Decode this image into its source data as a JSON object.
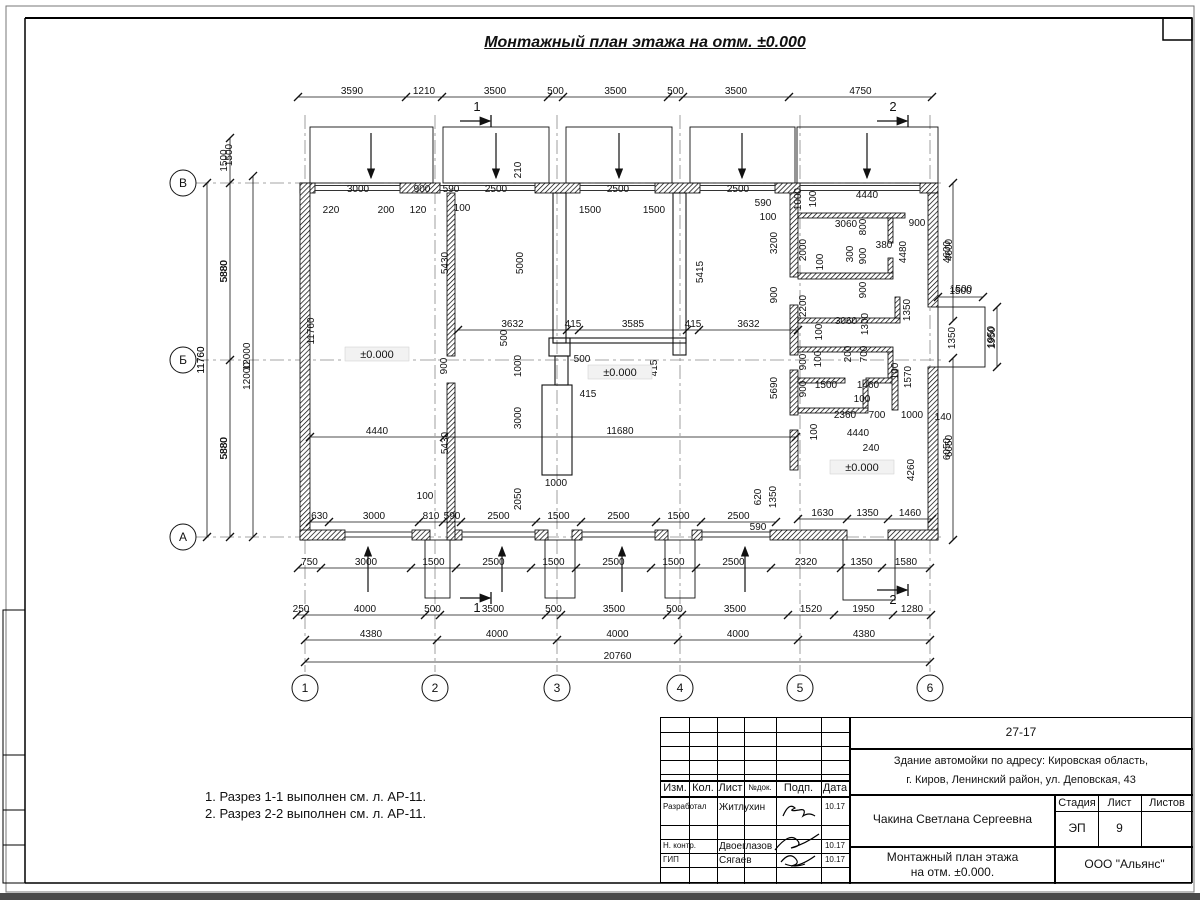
{
  "title": "Монтажный план этажа на отм. ±0.000",
  "notes": [
    "1. Разрез 1-1 выполнен см. л. АР-11.",
    "2. Разрез 2-2 выполнен см. л. АР-11."
  ],
  "colors": {
    "line": "#111111",
    "grid": "#888888",
    "level_bg": "#f2f2f2"
  },
  "plan": {
    "grid": {
      "cols": [
        {
          "label": "1",
          "x": 305
        },
        {
          "label": "2",
          "x": 435
        },
        {
          "label": "3",
          "x": 557
        },
        {
          "label": "4",
          "x": 680
        },
        {
          "label": "5",
          "x": 800
        },
        {
          "label": "6",
          "x": 930
        }
      ],
      "rows": [
        {
          "label": "В",
          "y": 183
        },
        {
          "label": "Б",
          "y": 360
        },
        {
          "label": "А",
          "y": 537
        }
      ]
    },
    "levels": [
      {
        "text": "±0.000",
        "x": 377,
        "y": 357
      },
      {
        "text": "±0.000",
        "x": 620,
        "y": 375
      },
      {
        "text": "±0.000",
        "x": 862,
        "y": 470
      }
    ],
    "sections": [
      {
        "label": "1",
        "tx": 477,
        "ty": 111,
        "lx": 460,
        "ly": 121
      },
      {
        "label": "2",
        "tx": 893,
        "ty": 111,
        "lx": 877,
        "ly": 121
      },
      {
        "label": "1",
        "tx": 477,
        "ty": 612,
        "lx": 460,
        "ly": 598
      },
      {
        "label": "2",
        "tx": 893,
        "ty": 604,
        "lx": 877,
        "ly": 590
      }
    ],
    "chains_h": [
      {
        "y": 97,
        "xs": [
          298,
          406,
          442,
          548,
          563,
          668,
          683,
          789,
          932
        ],
        "labels": [
          "3590",
          "1210",
          "3500",
          "500",
          "3500",
          "500",
          "3500",
          "4750"
        ]
      },
      {
        "y": 522,
        "xs": [
          310,
          329,
          419,
          443,
          461,
          536,
          581,
          656,
          701,
          776
        ],
        "labels": [
          "630",
          "3000",
          "810",
          "590",
          "2500",
          "1500",
          "2500",
          "1500",
          "2500"
        ]
      },
      {
        "y": 519,
        "xs": [
          798,
          847,
          888,
          932
        ],
        "labels": [
          "1630",
          "1350",
          "1460"
        ]
      },
      {
        "y": 568,
        "xs": [
          298,
          321,
          411,
          456,
          531,
          576,
          651,
          696,
          771,
          841,
          882,
          930
        ],
        "labels": [
          "750",
          "3000",
          "1500",
          "2500",
          "1500",
          "2500",
          "1500",
          "2500",
          "2320",
          "1350",
          "1580"
        ]
      },
      {
        "y": 615,
        "xs": [
          297,
          305,
          425,
          440,
          546,
          561,
          667,
          682,
          788,
          834,
          893,
          931
        ],
        "labels": [
          "250",
          "4000",
          "500",
          "3500",
          "500",
          "3500",
          "500",
          "3500",
          "1520",
          "1950",
          "1280"
        ]
      },
      {
        "y": 640,
        "xs": [
          305,
          437,
          557,
          678,
          798,
          930
        ],
        "labels": [
          "4380",
          "4000",
          "4000",
          "4000",
          "4380"
        ]
      },
      {
        "y": 662,
        "xs": [
          305,
          930
        ],
        "labels": [
          "20760"
        ]
      },
      {
        "y": 330,
        "xs": [
          458,
          567,
          579,
          687,
          699,
          798
        ],
        "labels": [
          "3632",
          "415",
          "3585",
          "415",
          "3632"
        ]
      },
      {
        "y": 437,
        "xs": [
          310,
          444,
          796
        ],
        "labels": [
          "4440",
          "11680"
        ]
      },
      {
        "y": 297,
        "xs": [
          938,
          983
        ],
        "labels": [
          "1500"
        ]
      }
    ],
    "chains_v": [
      {
        "x": 207,
        "ys": [
          183,
          537
        ],
        "labels": [
          "11760"
        ]
      },
      {
        "x": 230,
        "ys": [
          138,
          183,
          360,
          537
        ],
        "labels": [
          "1500",
          "5880",
          "5880"
        ]
      },
      {
        "x": 253,
        "ys": [
          176,
          537
        ],
        "labels": [
          "12000"
        ]
      },
      {
        "x": 953,
        "ys": [
          183,
          321
        ],
        "labels": [
          "4600"
        ]
      },
      {
        "x": 953,
        "ys": [
          358,
          540
        ],
        "labels": [
          "6050"
        ]
      },
      {
        "x": 997,
        "ys": [
          307,
          367
        ],
        "labels": [
          "1950"
        ]
      }
    ],
    "labels": [
      {
        "t": "3000",
        "x": 358,
        "y": 192
      },
      {
        "t": "900",
        "x": 422,
        "y": 192
      },
      {
        "t": "590",
        "x": 451,
        "y": 192
      },
      {
        "t": "2500",
        "x": 496,
        "y": 192
      },
      {
        "t": "2500",
        "x": 618,
        "y": 192
      },
      {
        "t": "2500",
        "x": 738,
        "y": 192
      },
      {
        "t": "590",
        "x": 763,
        "y": 206
      },
      {
        "t": "100",
        "x": 768,
        "y": 220
      },
      {
        "t": "4440",
        "x": 867,
        "y": 198
      },
      {
        "t": "220",
        "x": 331,
        "y": 213
      },
      {
        "t": "200",
        "x": 386,
        "y": 213
      },
      {
        "t": "120",
        "x": 418,
        "y": 213
      },
      {
        "t": "100",
        "x": 462,
        "y": 211
      },
      {
        "t": "1500",
        "x": 590,
        "y": 213
      },
      {
        "t": "1500",
        "x": 654,
        "y": 213
      },
      {
        "t": "210",
        "x": 521,
        "y": 170,
        "r": 1
      },
      {
        "t": "1500",
        "x": 232,
        "y": 155,
        "r": 1
      },
      {
        "t": "5880",
        "x": 227,
        "y": 271,
        "r": 1
      },
      {
        "t": "5880",
        "x": 227,
        "y": 448,
        "r": 1
      },
      {
        "t": "11760",
        "x": 204,
        "y": 360,
        "r": 1
      },
      {
        "t": "12000",
        "x": 250,
        "y": 376,
        "r": 1
      },
      {
        "t": "11760",
        "x": 314,
        "y": 331,
        "r": 1
      },
      {
        "t": "5430",
        "x": 448,
        "y": 263,
        "r": 1
      },
      {
        "t": "900",
        "x": 447,
        "y": 366,
        "r": 1
      },
      {
        "t": "5430",
        "x": 448,
        "y": 443,
        "r": 1
      },
      {
        "t": "5000",
        "x": 523,
        "y": 263,
        "r": 1
      },
      {
        "t": "5415",
        "x": 703,
        "y": 272,
        "r": 1
      },
      {
        "t": "500",
        "x": 507,
        "y": 338,
        "r": 1
      },
      {
        "t": "1000",
        "x": 521,
        "y": 366,
        "r": 1
      },
      {
        "t": "500",
        "x": 582,
        "y": 362
      },
      {
        "t": "415",
        "x": 657,
        "y": 368,
        "r": 1
      },
      {
        "t": "415",
        "x": 588,
        "y": 397
      },
      {
        "t": "3000",
        "x": 521,
        "y": 418,
        "r": 1
      },
      {
        "t": "2050",
        "x": 521,
        "y": 499,
        "r": 1
      },
      {
        "t": "1000",
        "x": 556,
        "y": 486
      },
      {
        "t": "100",
        "x": 425,
        "y": 499
      },
      {
        "t": "620",
        "x": 761,
        "y": 497,
        "r": 1
      },
      {
        "t": "1350",
        "x": 776,
        "y": 497,
        "r": 1
      },
      {
        "t": "590",
        "x": 758,
        "y": 530
      },
      {
        "t": "5690",
        "x": 777,
        "y": 388,
        "r": 1
      },
      {
        "t": "900",
        "x": 777,
        "y": 295,
        "r": 1
      },
      {
        "t": "3200",
        "x": 777,
        "y": 243,
        "r": 1
      },
      {
        "t": "1000",
        "x": 801,
        "y": 199,
        "r": 1
      },
      {
        "t": "100",
        "x": 816,
        "y": 199,
        "r": 1
      },
      {
        "t": "3060",
        "x": 846,
        "y": 227
      },
      {
        "t": "800",
        "x": 866,
        "y": 227,
        "r": 1
      },
      {
        "t": "900",
        "x": 917,
        "y": 226
      },
      {
        "t": "380",
        "x": 884,
        "y": 248
      },
      {
        "t": "2000",
        "x": 806,
        "y": 250,
        "r": 1
      },
      {
        "t": "100",
        "x": 823,
        "y": 262,
        "r": 1
      },
      {
        "t": "300",
        "x": 853,
        "y": 254,
        "r": 1
      },
      {
        "t": "900",
        "x": 866,
        "y": 256,
        "r": 1
      },
      {
        "t": "4480",
        "x": 906,
        "y": 252,
        "r": 1
      },
      {
        "t": "4600",
        "x": 952,
        "y": 250,
        "r": 1
      },
      {
        "t": "2200",
        "x": 806,
        "y": 306,
        "r": 1
      },
      {
        "t": "900",
        "x": 866,
        "y": 290,
        "r": 1
      },
      {
        "t": "3060",
        "x": 846,
        "y": 324
      },
      {
        "t": "1300",
        "x": 868,
        "y": 324,
        "r": 1
      },
      {
        "t": "100",
        "x": 822,
        "y": 332,
        "r": 1
      },
      {
        "t": "1350",
        "x": 910,
        "y": 310,
        "r": 1
      },
      {
        "t": "1500",
        "x": 961,
        "y": 292
      },
      {
        "t": "1350",
        "x": 955,
        "y": 338,
        "r": 1
      },
      {
        "t": "1950",
        "x": 995,
        "y": 338,
        "r": 1
      },
      {
        "t": "900",
        "x": 806,
        "y": 362,
        "r": 1
      },
      {
        "t": "100",
        "x": 821,
        "y": 359,
        "r": 1
      },
      {
        "t": "200",
        "x": 851,
        "y": 354,
        "r": 1
      },
      {
        "t": "700",
        "x": 867,
        "y": 354,
        "r": 1
      },
      {
        "t": "900",
        "x": 806,
        "y": 389,
        "r": 1
      },
      {
        "t": "100",
        "x": 898,
        "y": 371,
        "r": 1
      },
      {
        "t": "1570",
        "x": 911,
        "y": 377,
        "r": 1
      },
      {
        "t": "1500",
        "x": 826,
        "y": 388
      },
      {
        "t": "1460",
        "x": 868,
        "y": 388
      },
      {
        "t": "100",
        "x": 862,
        "y": 402
      },
      {
        "t": "100",
        "x": 817,
        "y": 432,
        "r": 1
      },
      {
        "t": "2360",
        "x": 845,
        "y": 418
      },
      {
        "t": "700",
        "x": 877,
        "y": 418
      },
      {
        "t": "1000",
        "x": 912,
        "y": 418
      },
      {
        "t": "140",
        "x": 943,
        "y": 420
      },
      {
        "t": "4440",
        "x": 858,
        "y": 436
      },
      {
        "t": "240",
        "x": 871,
        "y": 451
      },
      {
        "t": "4260",
        "x": 914,
        "y": 470,
        "r": 1
      },
      {
        "t": "6050",
        "x": 952,
        "y": 446,
        "r": 1
      }
    ]
  },
  "titleblock": {
    "doc_number": "27-17",
    "address_line1": "Здание автомойки по адресу: Кировская область,",
    "address_line2": "г. Киров, Ленинский район, ул. Деповская, 43",
    "header_cols": [
      "Изм.",
      "Кол.",
      "Лист",
      "№док.",
      "Подп.",
      "Дата"
    ],
    "rows": [
      {
        "role": "Разработал",
        "name": "Житлухин",
        "date": "10.17"
      },
      {
        "role": "Н. контр.",
        "name": "Двоеглазов",
        "date": "10.17"
      },
      {
        "role": "ГИП",
        "name": "Сягаев",
        "date": "10.17"
      }
    ],
    "client": "Чакина Светлана Сергеевна",
    "stage_label": "Стадия",
    "stage_value": "ЭП",
    "sheet_label": "Лист",
    "sheet_value": "9",
    "sheets_label": "Листов",
    "drawing_title_line1": "Монтажный план этажа",
    "drawing_title_line2": "на отм. ±0.000.",
    "company": "ООО \"Альянс\""
  }
}
